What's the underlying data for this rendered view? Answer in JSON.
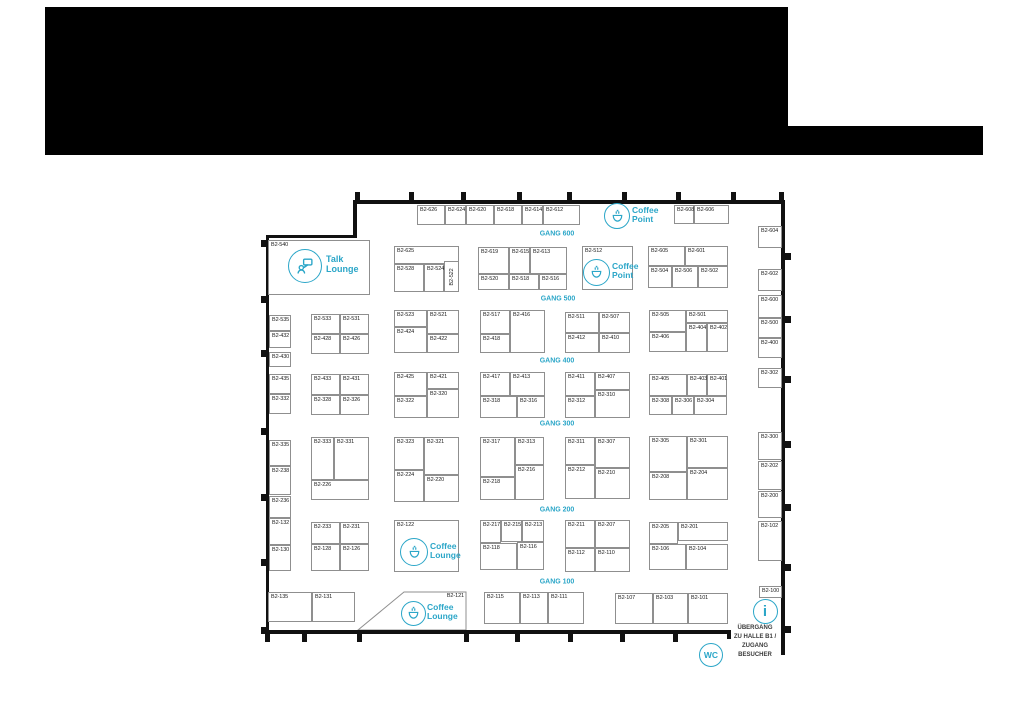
{
  "header": {
    "blocks": [
      [
        45,
        7,
        743,
        148
      ],
      [
        788,
        126,
        195,
        29
      ]
    ],
    "color": "#000000"
  },
  "plan": {
    "accent": "#2ba6c8",
    "booth_border": "#8f8f8f",
    "exit": {
      "x": 720,
      "y": 624,
      "w": 70,
      "lines": [
        "ÜBERGANG",
        "ZU HALLE B1 /",
        "ZUGANG",
        "BESUCHER"
      ]
    },
    "gangs": [
      {
        "label": "GANG 600",
        "x": 557,
        "y": 234
      },
      {
        "label": "GANG 500",
        "x": 558,
        "y": 299
      },
      {
        "label": "GANG 400",
        "x": 557,
        "y": 361
      },
      {
        "label": "GANG 300",
        "x": 557,
        "y": 424
      },
      {
        "label": "GANG 200",
        "x": 557,
        "y": 510
      },
      {
        "label": "GANG 100",
        "x": 557,
        "y": 582
      }
    ],
    "areas": [
      {
        "kind": "talk",
        "icon": "talk-lounge-icon",
        "cx": 305,
        "cy": 266,
        "r": 17,
        "tx": 326,
        "ty": 255,
        "fs": 9,
        "lines": [
          "Talk",
          "Lounge"
        ]
      },
      {
        "kind": "cup",
        "icon": "coffee-point-icon",
        "cx": 617,
        "cy": 216,
        "r": 13,
        "tx": 632,
        "ty": 206,
        "fs": 8.5,
        "lines": [
          "Coffee",
          "Point"
        ]
      },
      {
        "kind": "cup",
        "icon": "coffee-point-icon",
        "cx": 596,
        "cy": 272,
        "r": 13.5,
        "tx": 612,
        "ty": 262,
        "fs": 8.5,
        "lines": [
          "Coffee",
          "Point"
        ]
      },
      {
        "kind": "cup",
        "icon": "coffee-lounge-icon",
        "cx": 414,
        "cy": 552,
        "r": 14,
        "tx": 430,
        "ty": 542,
        "fs": 8.5,
        "lines": [
          "Coffee",
          "Lounge"
        ]
      },
      {
        "kind": "cup",
        "icon": "coffee-lounge-icon",
        "cx": 413,
        "cy": 613,
        "r": 12.5,
        "tx": 427,
        "ty": 603,
        "fs": 8.5,
        "lines": [
          "Coffee",
          "Lounge"
        ]
      },
      {
        "kind": "info",
        "icon": "info-icon",
        "cx": 765,
        "cy": 611,
        "r": 12.5
      },
      {
        "kind": "wc",
        "icon": "wc-icon",
        "cx": 711,
        "cy": 655,
        "r": 12,
        "label": "WC"
      }
    ],
    "walls": [
      [
        353,
        200,
        432,
        4
      ],
      [
        353,
        200,
        4,
        38
      ],
      [
        267,
        235,
        90,
        3
      ],
      [
        266,
        235,
        3,
        399
      ],
      [
        264,
        630,
        467,
        4
      ],
      [
        727,
        630,
        4,
        9
      ],
      [
        781,
        200,
        4,
        455
      ]
    ],
    "ticks": [
      [
        355,
        192,
        5,
        9
      ],
      [
        409,
        192,
        5,
        9
      ],
      [
        461,
        192,
        5,
        9
      ],
      [
        517,
        192,
        5,
        9
      ],
      [
        567,
        192,
        5,
        9
      ],
      [
        622,
        192,
        5,
        9
      ],
      [
        676,
        192,
        5,
        9
      ],
      [
        731,
        192,
        5,
        9
      ],
      [
        779,
        192,
        5,
        9
      ],
      [
        265,
        634,
        5,
        8
      ],
      [
        302,
        634,
        5,
        8
      ],
      [
        357,
        634,
        5,
        8
      ],
      [
        464,
        634,
        5,
        8
      ],
      [
        515,
        634,
        5,
        8
      ],
      [
        568,
        634,
        5,
        8
      ],
      [
        620,
        634,
        5,
        8
      ],
      [
        673,
        634,
        5,
        8
      ],
      [
        261,
        240,
        6,
        7
      ],
      [
        261,
        296,
        6,
        7
      ],
      [
        261,
        350,
        6,
        7
      ],
      [
        261,
        428,
        6,
        7
      ],
      [
        261,
        494,
        6,
        7
      ],
      [
        261,
        559,
        6,
        7
      ],
      [
        261,
        627,
        6,
        7
      ],
      [
        785,
        253,
        6,
        7
      ],
      [
        785,
        316,
        6,
        7
      ],
      [
        785,
        376,
        6,
        7
      ],
      [
        785,
        441,
        6,
        7
      ],
      [
        785,
        504,
        6,
        7
      ],
      [
        785,
        564,
        6,
        7
      ],
      [
        785,
        626,
        6,
        7
      ]
    ],
    "booths": [
      {
        "id": "B2-626",
        "x": 417,
        "y": 205,
        "w": 28,
        "h": 20
      },
      {
        "id": "B2-624",
        "x": 445,
        "y": 205,
        "w": 21,
        "h": 20
      },
      {
        "id": "B2-620",
        "x": 466,
        "y": 205,
        "w": 28,
        "h": 20
      },
      {
        "id": "B2-618",
        "x": 494,
        "y": 205,
        "w": 28,
        "h": 20
      },
      {
        "id": "B2-614",
        "x": 522,
        "y": 205,
        "w": 21,
        "h": 20
      },
      {
        "id": "B2-612",
        "x": 543,
        "y": 205,
        "w": 37,
        "h": 20
      },
      {
        "id": "B2-608",
        "x": 674,
        "y": 205,
        "w": 20,
        "h": 19
      },
      {
        "id": "B2-606",
        "x": 694,
        "y": 205,
        "w": 35,
        "h": 19
      },
      {
        "id": "B2-604",
        "x": 758,
        "y": 226,
        "w": 24,
        "h": 22
      },
      {
        "id": "B2-602",
        "x": 758,
        "y": 269,
        "w": 24,
        "h": 22
      },
      {
        "id": "B2-600",
        "x": 758,
        "y": 295,
        "w": 24,
        "h": 23
      },
      {
        "id": "B2-500",
        "x": 758,
        "y": 318,
        "w": 24,
        "h": 20
      },
      {
        "id": "B2-400",
        "x": 758,
        "y": 338,
        "w": 24,
        "h": 20
      },
      {
        "id": "B2-302",
        "x": 758,
        "y": 368,
        "w": 24,
        "h": 20
      },
      {
        "id": "B2-300",
        "x": 758,
        "y": 432,
        "w": 24,
        "h": 28
      },
      {
        "id": "B2-202",
        "x": 758,
        "y": 461,
        "w": 24,
        "h": 29
      },
      {
        "id": "B2-200",
        "x": 758,
        "y": 491,
        "w": 24,
        "h": 27
      },
      {
        "id": "B2-102",
        "x": 758,
        "y": 521,
        "w": 24,
        "h": 40
      },
      {
        "id": "B2-100",
        "x": 759,
        "y": 586,
        "w": 23,
        "h": 12
      },
      {
        "id": "B2-540",
        "x": 268,
        "y": 240,
        "w": 102,
        "h": 55
      },
      {
        "id": "B2-625",
        "x": 394,
        "y": 246,
        "w": 65,
        "h": 18
      },
      {
        "id": "B2-528",
        "x": 394,
        "y": 264,
        "w": 30,
        "h": 28
      },
      {
        "id": "B2-524",
        "x": 424,
        "y": 264,
        "w": 20,
        "h": 28
      },
      {
        "id": "B2-522",
        "x": 444,
        "y": 261,
        "w": 15,
        "h": 31,
        "rot": true
      },
      {
        "id": "B2-619",
        "x": 478,
        "y": 247,
        "w": 31,
        "h": 27
      },
      {
        "id": "B2-615",
        "x": 509,
        "y": 247,
        "w": 21,
        "h": 27
      },
      {
        "id": "B2-613",
        "x": 530,
        "y": 247,
        "w": 37,
        "h": 27
      },
      {
        "id": "B2-520",
        "x": 478,
        "y": 274,
        "w": 31,
        "h": 16
      },
      {
        "id": "B2-518",
        "x": 509,
        "y": 274,
        "w": 30,
        "h": 16
      },
      {
        "id": "B2-516",
        "x": 539,
        "y": 274,
        "w": 28,
        "h": 16
      },
      {
        "id": "B2-512",
        "x": 582,
        "y": 246,
        "w": 51,
        "h": 44
      },
      {
        "id": "B2-605",
        "x": 648,
        "y": 246,
        "w": 37,
        "h": 20
      },
      {
        "id": "B2-601",
        "x": 685,
        "y": 246,
        "w": 43,
        "h": 20
      },
      {
        "id": "B2-504",
        "x": 648,
        "y": 266,
        "w": 24,
        "h": 22
      },
      {
        "id": "B2-506",
        "x": 672,
        "y": 266,
        "w": 26,
        "h": 22
      },
      {
        "id": "B2-502",
        "x": 698,
        "y": 266,
        "w": 30,
        "h": 22
      },
      {
        "id": "B2-535",
        "x": 269,
        "y": 315,
        "w": 22,
        "h": 16
      },
      {
        "id": "B2-432",
        "x": 269,
        "y": 331,
        "w": 22,
        "h": 17
      },
      {
        "id": "B2-430",
        "x": 269,
        "y": 352,
        "w": 22,
        "h": 15
      },
      {
        "id": "B2-533",
        "x": 311,
        "y": 314,
        "w": 29,
        "h": 20
      },
      {
        "id": "B2-531",
        "x": 340,
        "y": 314,
        "w": 29,
        "h": 20
      },
      {
        "id": "B2-428",
        "x": 311,
        "y": 334,
        "w": 29,
        "h": 20
      },
      {
        "id": "B2-426",
        "x": 340,
        "y": 334,
        "w": 29,
        "h": 20
      },
      {
        "id": "B2-523",
        "x": 394,
        "y": 310,
        "w": 33,
        "h": 17
      },
      {
        "id": "B2-424",
        "x": 394,
        "y": 327,
        "w": 33,
        "h": 26
      },
      {
        "id": "B2-521",
        "x": 427,
        "y": 310,
        "w": 32,
        "h": 24
      },
      {
        "id": "B2-422",
        "x": 427,
        "y": 334,
        "w": 32,
        "h": 19
      },
      {
        "id": "B2-517",
        "x": 480,
        "y": 310,
        "w": 30,
        "h": 24
      },
      {
        "id": "B2-416",
        "x": 510,
        "y": 310,
        "w": 35,
        "h": 43
      },
      {
        "id": "B2-418",
        "x": 480,
        "y": 334,
        "w": 30,
        "h": 19
      },
      {
        "id": "B2-511",
        "x": 565,
        "y": 312,
        "w": 34,
        "h": 21
      },
      {
        "id": "B2-507",
        "x": 599,
        "y": 312,
        "w": 31,
        "h": 21
      },
      {
        "id": "B2-412",
        "x": 565,
        "y": 333,
        "w": 34,
        "h": 20
      },
      {
        "id": "B2-410",
        "x": 599,
        "y": 333,
        "w": 31,
        "h": 20
      },
      {
        "id": "B2-505",
        "x": 649,
        "y": 310,
        "w": 37,
        "h": 22
      },
      {
        "id": "B2-501",
        "x": 686,
        "y": 310,
        "w": 42,
        "h": 13
      },
      {
        "id": "B2-404",
        "x": 686,
        "y": 323,
        "w": 21,
        "h": 29
      },
      {
        "id": "B2-402",
        "x": 707,
        "y": 323,
        "w": 21,
        "h": 29
      },
      {
        "id": "B2-406",
        "x": 649,
        "y": 332,
        "w": 37,
        "h": 20
      },
      {
        "id": "B2-435",
        "x": 269,
        "y": 374,
        "w": 22,
        "h": 20
      },
      {
        "id": "B2-332",
        "x": 269,
        "y": 394,
        "w": 22,
        "h": 20
      },
      {
        "id": "B2-433",
        "x": 311,
        "y": 374,
        "w": 29,
        "h": 21
      },
      {
        "id": "B2-431",
        "x": 340,
        "y": 374,
        "w": 29,
        "h": 21
      },
      {
        "id": "B2-328",
        "x": 311,
        "y": 395,
        "w": 29,
        "h": 20
      },
      {
        "id": "B2-326",
        "x": 340,
        "y": 395,
        "w": 29,
        "h": 20
      },
      {
        "id": "B2-425",
        "x": 394,
        "y": 372,
        "w": 33,
        "h": 24
      },
      {
        "id": "B2-421",
        "x": 427,
        "y": 372,
        "w": 32,
        "h": 17
      },
      {
        "id": "B2-320",
        "x": 427,
        "y": 389,
        "w": 32,
        "h": 29
      },
      {
        "id": "B2-322",
        "x": 394,
        "y": 396,
        "w": 33,
        "h": 22
      },
      {
        "id": "B2-417",
        "x": 480,
        "y": 372,
        "w": 30,
        "h": 24
      },
      {
        "id": "B2-413",
        "x": 510,
        "y": 372,
        "w": 35,
        "h": 24
      },
      {
        "id": "B2-318",
        "x": 480,
        "y": 396,
        "w": 37,
        "h": 22
      },
      {
        "id": "B2-316",
        "x": 517,
        "y": 396,
        "w": 28,
        "h": 22
      },
      {
        "id": "B2-411",
        "x": 565,
        "y": 372,
        "w": 30,
        "h": 24
      },
      {
        "id": "B2-407",
        "x": 595,
        "y": 372,
        "w": 35,
        "h": 18
      },
      {
        "id": "B2-310",
        "x": 595,
        "y": 390,
        "w": 35,
        "h": 28
      },
      {
        "id": "B2-312",
        "x": 565,
        "y": 396,
        "w": 30,
        "h": 22
      },
      {
        "id": "B2-405",
        "x": 649,
        "y": 374,
        "w": 38,
        "h": 22
      },
      {
        "id": "B2-403",
        "x": 687,
        "y": 374,
        "w": 20,
        "h": 22
      },
      {
        "id": "B2-401",
        "x": 707,
        "y": 374,
        "w": 20,
        "h": 22
      },
      {
        "id": "B2-308",
        "x": 649,
        "y": 396,
        "w": 23,
        "h": 19
      },
      {
        "id": "B2-306",
        "x": 672,
        "y": 396,
        "w": 22,
        "h": 19
      },
      {
        "id": "B2-304",
        "x": 694,
        "y": 396,
        "w": 33,
        "h": 19
      },
      {
        "id": "B2-335",
        "x": 269,
        "y": 440,
        "w": 22,
        "h": 26
      },
      {
        "id": "B2-238",
        "x": 269,
        "y": 466,
        "w": 22,
        "h": 29
      },
      {
        "id": "B2-236",
        "x": 269,
        "y": 496,
        "w": 22,
        "h": 22
      },
      {
        "id": "B2-333",
        "x": 311,
        "y": 437,
        "w": 23,
        "h": 43
      },
      {
        "id": "B2-331",
        "x": 334,
        "y": 437,
        "w": 35,
        "h": 43
      },
      {
        "id": "B2-226",
        "x": 311,
        "y": 480,
        "w": 58,
        "h": 20
      },
      {
        "id": "B2-323",
        "x": 394,
        "y": 437,
        "w": 30,
        "h": 33
      },
      {
        "id": "B2-224",
        "x": 394,
        "y": 470,
        "w": 30,
        "h": 32
      },
      {
        "id": "B2-321",
        "x": 424,
        "y": 437,
        "w": 35,
        "h": 38
      },
      {
        "id": "B2-220",
        "x": 424,
        "y": 475,
        "w": 35,
        "h": 27
      },
      {
        "id": "B2-317",
        "x": 480,
        "y": 437,
        "w": 35,
        "h": 40
      },
      {
        "id": "B2-313",
        "x": 515,
        "y": 437,
        "w": 29,
        "h": 28
      },
      {
        "id": "B2-216",
        "x": 515,
        "y": 465,
        "w": 29,
        "h": 35
      },
      {
        "id": "B2-218",
        "x": 480,
        "y": 477,
        "w": 35,
        "h": 23
      },
      {
        "id": "B2-311",
        "x": 565,
        "y": 437,
        "w": 30,
        "h": 28
      },
      {
        "id": "B2-307",
        "x": 595,
        "y": 437,
        "w": 35,
        "h": 31
      },
      {
        "id": "B2-212",
        "x": 565,
        "y": 465,
        "w": 30,
        "h": 34
      },
      {
        "id": "B2-210",
        "x": 595,
        "y": 468,
        "w": 35,
        "h": 31
      },
      {
        "id": "B2-305",
        "x": 649,
        "y": 436,
        "w": 38,
        "h": 36
      },
      {
        "id": "B2-301",
        "x": 687,
        "y": 436,
        "w": 41,
        "h": 32
      },
      {
        "id": "B2-204",
        "x": 687,
        "y": 468,
        "w": 41,
        "h": 32
      },
      {
        "id": "B2-208",
        "x": 649,
        "y": 472,
        "w": 38,
        "h": 28
      },
      {
        "id": "B2-132",
        "x": 269,
        "y": 518,
        "w": 22,
        "h": 27
      },
      {
        "id": "B2-130",
        "x": 269,
        "y": 545,
        "w": 22,
        "h": 26
      },
      {
        "id": "B2-233",
        "x": 311,
        "y": 522,
        "w": 29,
        "h": 22
      },
      {
        "id": "B2-231",
        "x": 340,
        "y": 522,
        "w": 29,
        "h": 22
      },
      {
        "id": "B2-128",
        "x": 311,
        "y": 544,
        "w": 29,
        "h": 27
      },
      {
        "id": "B2-126",
        "x": 340,
        "y": 544,
        "w": 29,
        "h": 27
      },
      {
        "id": "B2-122",
        "x": 394,
        "y": 520,
        "w": 65,
        "h": 52
      },
      {
        "id": "B2-217",
        "x": 480,
        "y": 520,
        "w": 21,
        "h": 23
      },
      {
        "id": "B2-215",
        "x": 501,
        "y": 520,
        "w": 21,
        "h": 22
      },
      {
        "id": "B2-213",
        "x": 522,
        "y": 520,
        "w": 22,
        "h": 22
      },
      {
        "id": "B2-118",
        "x": 480,
        "y": 543,
        "w": 37,
        "h": 27
      },
      {
        "id": "B2-116",
        "x": 517,
        "y": 542,
        "w": 27,
        "h": 28
      },
      {
        "id": "B2-211",
        "x": 565,
        "y": 520,
        "w": 30,
        "h": 28
      },
      {
        "id": "B2-207",
        "x": 595,
        "y": 520,
        "w": 35,
        "h": 28
      },
      {
        "id": "B2-112",
        "x": 565,
        "y": 548,
        "w": 30,
        "h": 24
      },
      {
        "id": "B2-110",
        "x": 595,
        "y": 548,
        "w": 35,
        "h": 24
      },
      {
        "id": "B2-205",
        "x": 649,
        "y": 522,
        "w": 29,
        "h": 22
      },
      {
        "id": "B2-201",
        "x": 678,
        "y": 522,
        "w": 50,
        "h": 19
      },
      {
        "id": "B2-106",
        "x": 649,
        "y": 544,
        "w": 37,
        "h": 26
      },
      {
        "id": "B2-104",
        "x": 686,
        "y": 544,
        "w": 42,
        "h": 26
      },
      {
        "id": "B2-135",
        "x": 268,
        "y": 592,
        "w": 44,
        "h": 30
      },
      {
        "id": "B2-131",
        "x": 312,
        "y": 592,
        "w": 43,
        "h": 30
      },
      {
        "id": "B2-121",
        "x": 404,
        "y": 592,
        "w": 62,
        "h": 39,
        "la": "r",
        "poly": "404,592 466,592 466,630 358,630"
      },
      {
        "id": "B2-115",
        "x": 484,
        "y": 592,
        "w": 36,
        "h": 32
      },
      {
        "id": "B2-113",
        "x": 520,
        "y": 592,
        "w": 28,
        "h": 32
      },
      {
        "id": "B2-111",
        "x": 548,
        "y": 592,
        "w": 36,
        "h": 32
      },
      {
        "id": "B2-107",
        "x": 615,
        "y": 593,
        "w": 38,
        "h": 31
      },
      {
        "id": "B2-103",
        "x": 653,
        "y": 593,
        "w": 35,
        "h": 31
      },
      {
        "id": "B2-101",
        "x": 688,
        "y": 593,
        "w": 40,
        "h": 31
      }
    ]
  }
}
